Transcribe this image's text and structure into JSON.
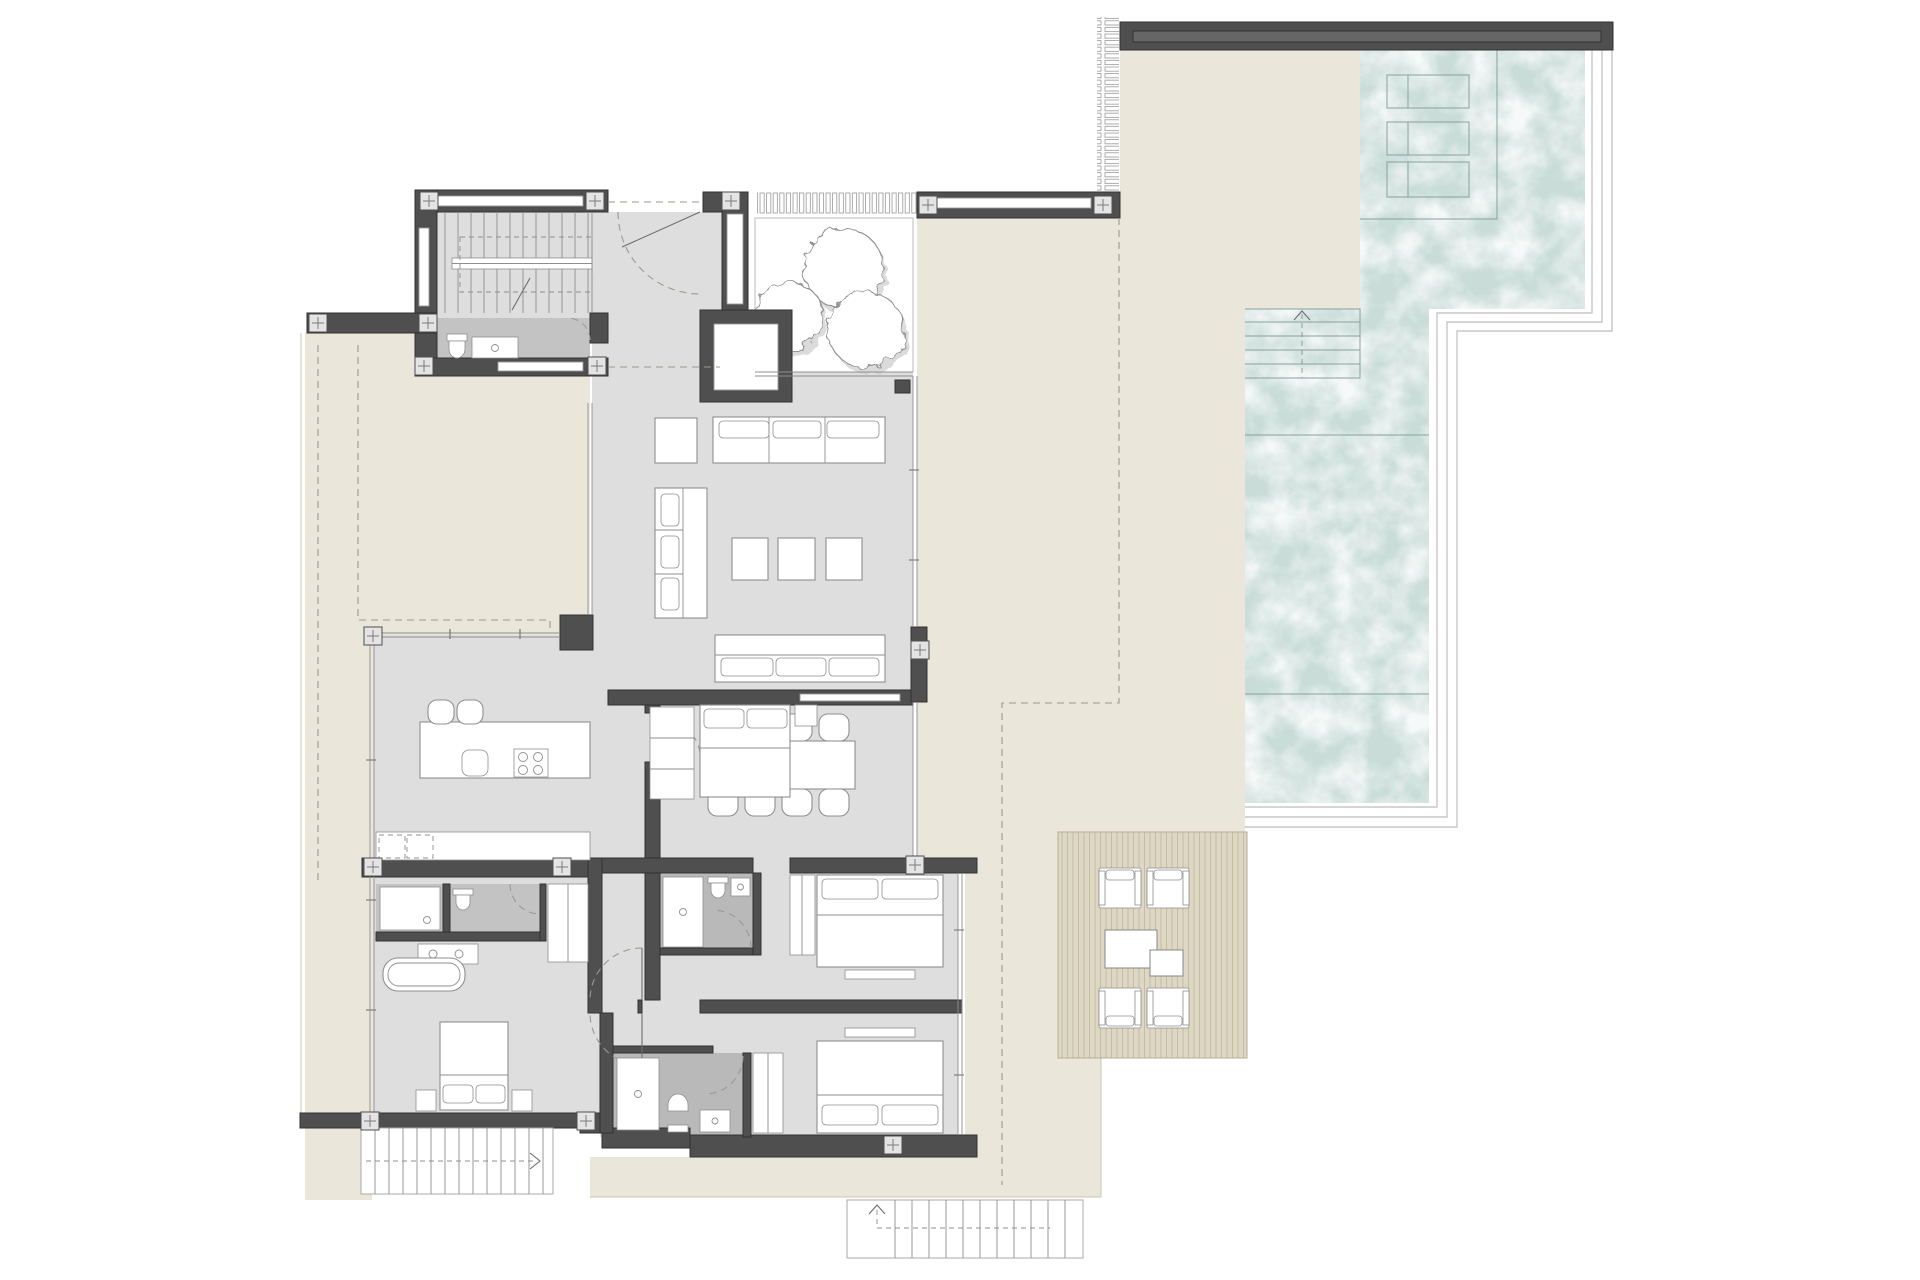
{
  "diagram": {
    "kind": "architectural-floor-plan",
    "visible_text": "none"
  },
  "palette": {
    "wall": "#4f4f4f",
    "wall-edge": "#323232",
    "floor": "#dedede",
    "wet": "#c3c3c3",
    "wet2": "#b9b9b9",
    "terrace": "#eae6da",
    "terr-edge": "#ccc6b5",
    "deck": "#ddd7c3",
    "deck-line": "#c4bda6",
    "pool": "#c9dcd8",
    "pool-line": "#87a19d",
    "coping": "#c7c7c7",
    "line": "#8f8f8f",
    "line-dark": "#6e6e6e",
    "dash": "#9a9a8e"
  },
  "features": [
    {
      "name": "pool",
      "kind": "water"
    },
    {
      "name": "pool-tanning-shelf",
      "kind": "water-zone"
    },
    {
      "name": "pool-steps",
      "kind": "stairs"
    },
    {
      "name": "wood-deck",
      "kind": "decking"
    },
    {
      "name": "terrace",
      "kind": "paving"
    },
    {
      "name": "planter-courtyard",
      "kind": "landscape"
    },
    {
      "name": "trees",
      "kind": "landscape"
    },
    {
      "name": "louver-screen",
      "kind": "screen"
    },
    {
      "name": "interior-staircase",
      "kind": "stairs"
    },
    {
      "name": "exterior-staircase-left",
      "kind": "stairs"
    },
    {
      "name": "exterior-staircase-bottom",
      "kind": "stairs"
    },
    {
      "name": "living-room",
      "kind": "room"
    },
    {
      "name": "dining-area",
      "kind": "room"
    },
    {
      "name": "kitchen",
      "kind": "room"
    },
    {
      "name": "master-suite",
      "kind": "room"
    },
    {
      "name": "bedroom-2",
      "kind": "room"
    },
    {
      "name": "bedroom-3",
      "kind": "room"
    },
    {
      "name": "bedroom-4",
      "kind": "room"
    },
    {
      "name": "powder-room",
      "kind": "room"
    },
    {
      "name": "fireplace-chimney",
      "kind": "structure"
    }
  ],
  "inventory": {
    "trees": 3,
    "pool_loungers": 3,
    "dining_chairs": 8,
    "bar_stools": 2,
    "ottomans": 3,
    "deck_armchairs": 4,
    "deck_tables": 2,
    "beds": 4,
    "sofas": 3,
    "bathtubs": 1,
    "showers": 4,
    "toilets": 5
  }
}
